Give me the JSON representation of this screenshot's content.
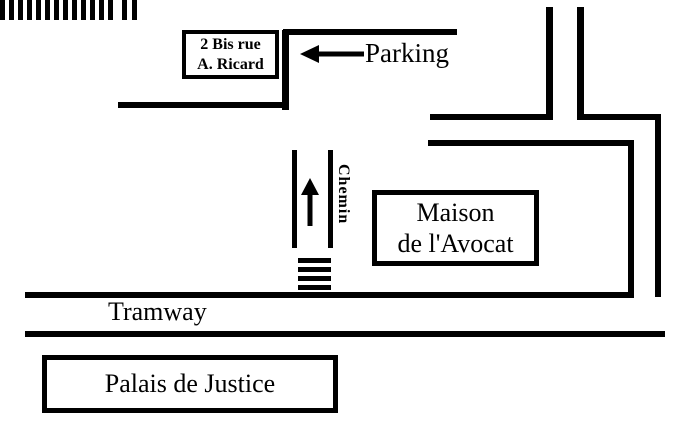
{
  "colors": {
    "background": "#ffffff",
    "ink": "#000000"
  },
  "labels": {
    "address": {
      "line1": "2 Bis rue",
      "line2": "A. Ricard"
    },
    "parking": "Parking",
    "chemin": "Chemin",
    "maison": {
      "line1": "Maison",
      "line2": "de l'Avocat"
    },
    "tramway": "Tramway",
    "palais": "Palais de Justice"
  },
  "decor": {
    "parking_arrow": "left-arrow",
    "chemin_arrow": "up-arrow",
    "parking_hatch": {
      "bars": 13,
      "extra_bars": 2
    },
    "crosswalk": {
      "bars": 4
    }
  }
}
